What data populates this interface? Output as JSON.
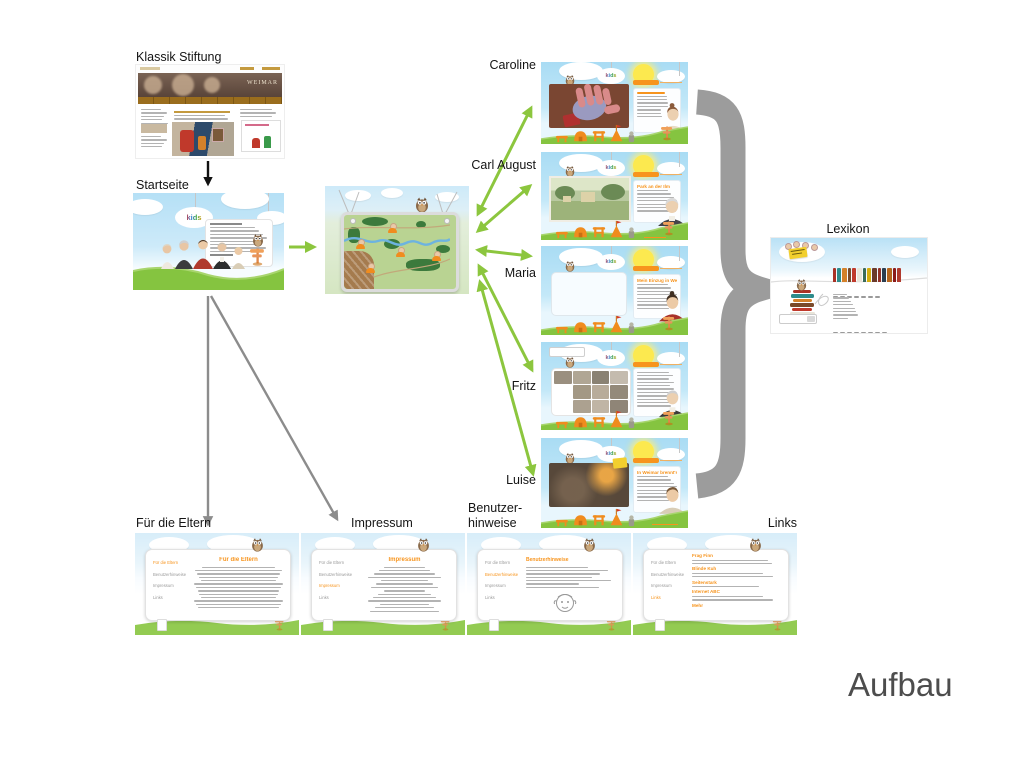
{
  "diagram_title": "Aufbau",
  "labels": {
    "klassik": "Klassik Stiftung",
    "startseite": "Startseite",
    "caroline": "Caroline",
    "carl_august": "Carl August",
    "maria": "Maria",
    "fritz": "Fritz",
    "luise": "Luise",
    "lexikon": "Lexikon",
    "eltern": "Für die Eltern",
    "impressum": "Impressum",
    "hinweise_line1": "Benutzer-",
    "hinweise_line2": "hinweise",
    "links": "Links"
  },
  "thumbs": {
    "kids_logo": "kids",
    "klassik_banner": "WEIMAR",
    "carl_august_heading": "Park an der Ilm",
    "maria_heading": "Mein Einzug in Weimar",
    "luise_heading": "In Weimar brennt's",
    "eltern_title": "Für die Eltern",
    "impressum_title": "Impressum",
    "hinweise_title": "Benutzerhinweise",
    "links_headings": [
      "Frag Finn",
      "Blinde Kuh",
      "Seitenstark",
      "Internet ABC"
    ],
    "links_more": "Mehr",
    "footer_menu": [
      "Für die Eltern",
      "Benutzerhinweise",
      "Impressum",
      "Links"
    ]
  },
  "colors": {
    "arrow_green": "#8cc63e",
    "arrow_gray": "#8c8c8c",
    "arrow_black": "#111111",
    "brace_gray": "#9c9c9c",
    "kids_orange": "#f7941d",
    "grass_green": "#85c440",
    "sky_blue": "#b5e0f6"
  },
  "lexikon_books": [
    "#a93226",
    "#2e8b8b",
    "#d4812a",
    "#7a4a2a",
    "#c0392b",
    "#e8e4d8",
    "#3a6b5a",
    "#d4ac0d",
    "#6b3a2a",
    "#943126",
    "#2c3e50",
    "#b5651d",
    "#8b1a1a",
    "#b03a2e"
  ]
}
